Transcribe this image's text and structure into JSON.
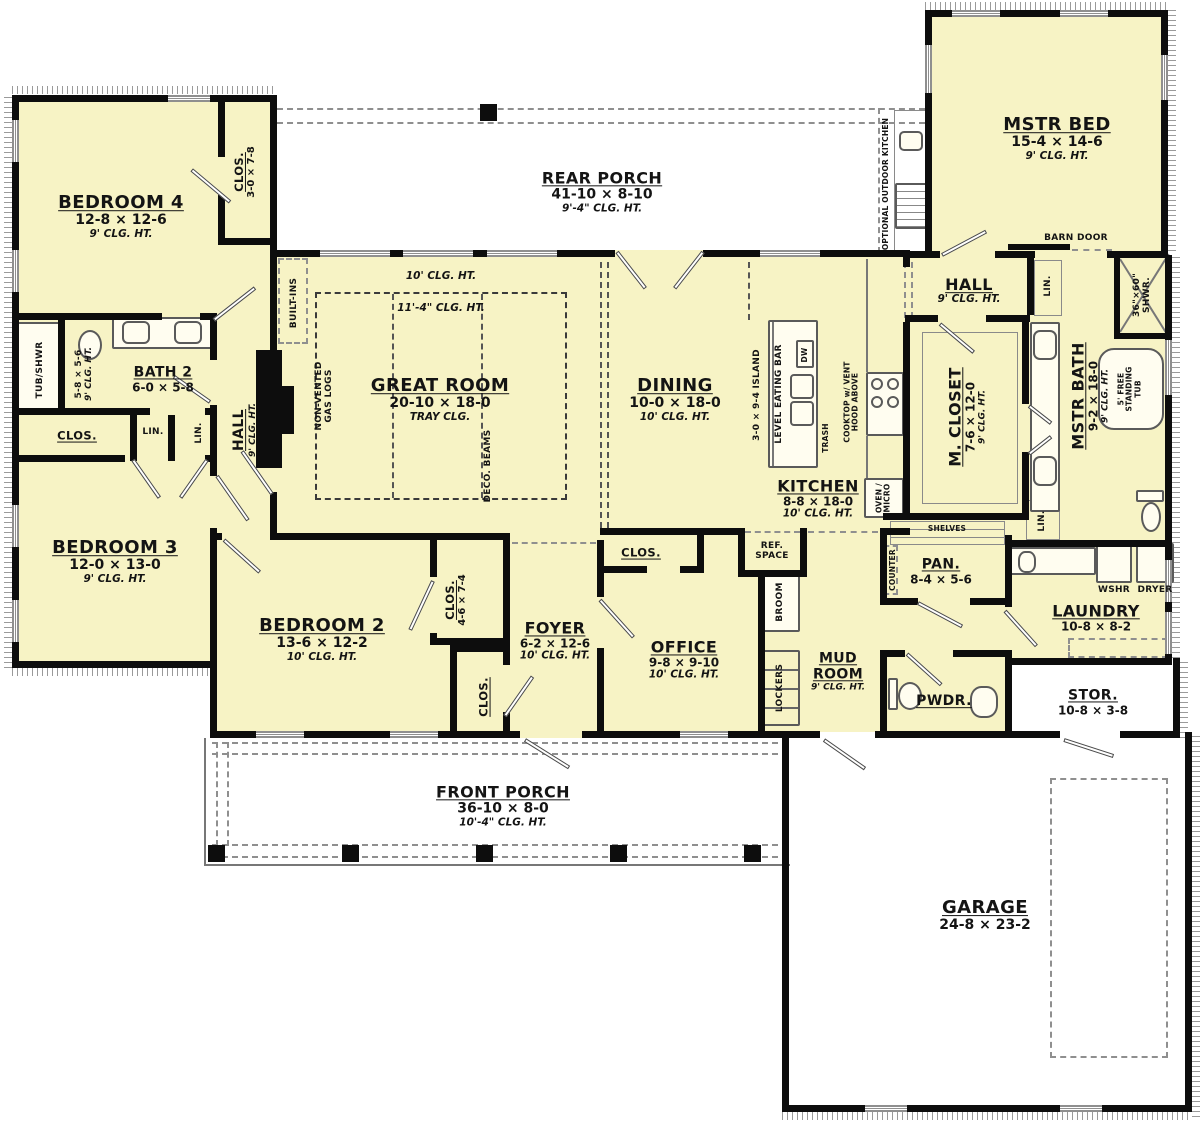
{
  "colors": {
    "room_fill": "#f7f3c5",
    "wall": "#0d0d0d",
    "dash_gray": "#8f8f8f",
    "porch_white": "#ffffff"
  },
  "rooms": {
    "rear_porch": {
      "name": "REAR PORCH",
      "dims": "41-10 × 8-10",
      "clg": "9'-4\" CLG. HT."
    },
    "front_porch": {
      "name": "FRONT PORCH",
      "dims": "36-10 × 8-0",
      "clg": "10'-4\" CLG. HT."
    },
    "garage": {
      "name": "GARAGE",
      "dims": "24-8 × 23-2"
    },
    "mstr_bed": {
      "name": "MSTR BED",
      "dims": "15-4 × 14-6",
      "clg": "9' CLG. HT."
    },
    "bedroom4": {
      "name": "BEDROOM 4",
      "dims": "12-8 × 12-6",
      "clg": "9' CLG. HT."
    },
    "clos_b4": {
      "name": "CLOS.",
      "dims": "3-0 × 7-8"
    },
    "bath2": {
      "name": "BATH 2",
      "dims": "6-0 × 5-8"
    },
    "bath2_tub_room": {
      "dims": "5-8 × 5-6",
      "clg": "9' CLG. HT."
    },
    "hall_left": {
      "name": "HALL",
      "clg": "9' CLG. HT."
    },
    "bedroom3": {
      "name": "BEDROOM 3",
      "dims": "12-0 × 13-0",
      "clg": "9' CLG. HT."
    },
    "great_room": {
      "name": "GREAT ROOM",
      "dims": "20-10 × 18-0",
      "tray": "TRAY CLG.",
      "clg10": "10' CLG. HT.",
      "clg11": "11'-4\" CLG. HT."
    },
    "dining": {
      "name": "DINING",
      "dims": "10-0 × 18-0",
      "clg": "10' CLG. HT."
    },
    "kitchen": {
      "name": "KITCHEN",
      "dims": "8-8 × 18-0",
      "clg": "10' CLG. HT."
    },
    "hall_right": {
      "name": "HALL",
      "clg": "9' CLG. HT."
    },
    "m_closet": {
      "name": "M. CLOSET",
      "dims": "7-6 × 12-0",
      "clg": "9' CLG. HT."
    },
    "mstr_bath": {
      "name": "MSTR BATH",
      "dims": "9-2 × 18-0",
      "cl g": "",
      "clg": "9' CLG. HT."
    },
    "pan": {
      "name": "PAN.",
      "dims": "8-4 × 5-6"
    },
    "laundry": {
      "name": "LAUNDRY",
      "dims": "10-8 × 8-2"
    },
    "pwdr": {
      "name": "PWDR."
    },
    "stor": {
      "name": "STOR.",
      "dims": "10-8 × 3-8"
    },
    "mud_room": {
      "name": "MUD ROOM",
      "clg": "9' CLG. HT."
    },
    "office": {
      "name": "OFFICE",
      "dims": "9-8 × 9-10",
      "clg": "10' CLG. HT."
    },
    "foyer": {
      "name": "FOYER",
      "dims": "6-2 × 12-6",
      "clg": "10' CLG. HT."
    },
    "clos_46": {
      "name": "CLOS.",
      "dims": "4-6 × 7-4"
    },
    "bedroom2": {
      "name": "BEDROOM 2",
      "dims": "13-6 × 12-2",
      "clg": "10' CLG. HT."
    }
  },
  "labels": {
    "lin": "LIN.",
    "clos": "CLOS."
  },
  "fixtures": {
    "wshr": "WSHR",
    "dryer": "DRYER",
    "dw": "DW",
    "trash": "TRASH",
    "shelves": "SHELVES",
    "counter": "COUNTER",
    "broom": "BROOM",
    "lockers": "LOCKERS",
    "ref_space": "REF. SPACE",
    "oven_micro": "OVEN / MICRO",
    "cooktop": "COOKTOP w/ VENT HOOD ABOVE",
    "island": "3-0 × 9-4 ISLAND",
    "eating_bar": "LEVEL EATING BAR",
    "built_ins": "BUILT-INS",
    "gas_logs": "NON-VENTED GAS LOGS",
    "deco_beams": "DECO. BEAMS",
    "tub_shwr": "TUB/SHWR",
    "shower": "36\"×60\" SHWR.",
    "free_tub": "5' FREE STANDING TUB",
    "barn_door": "BARN DOOR",
    "outdoor_kitchen": "OPTIONAL OUTDOOR KITCHEN"
  }
}
